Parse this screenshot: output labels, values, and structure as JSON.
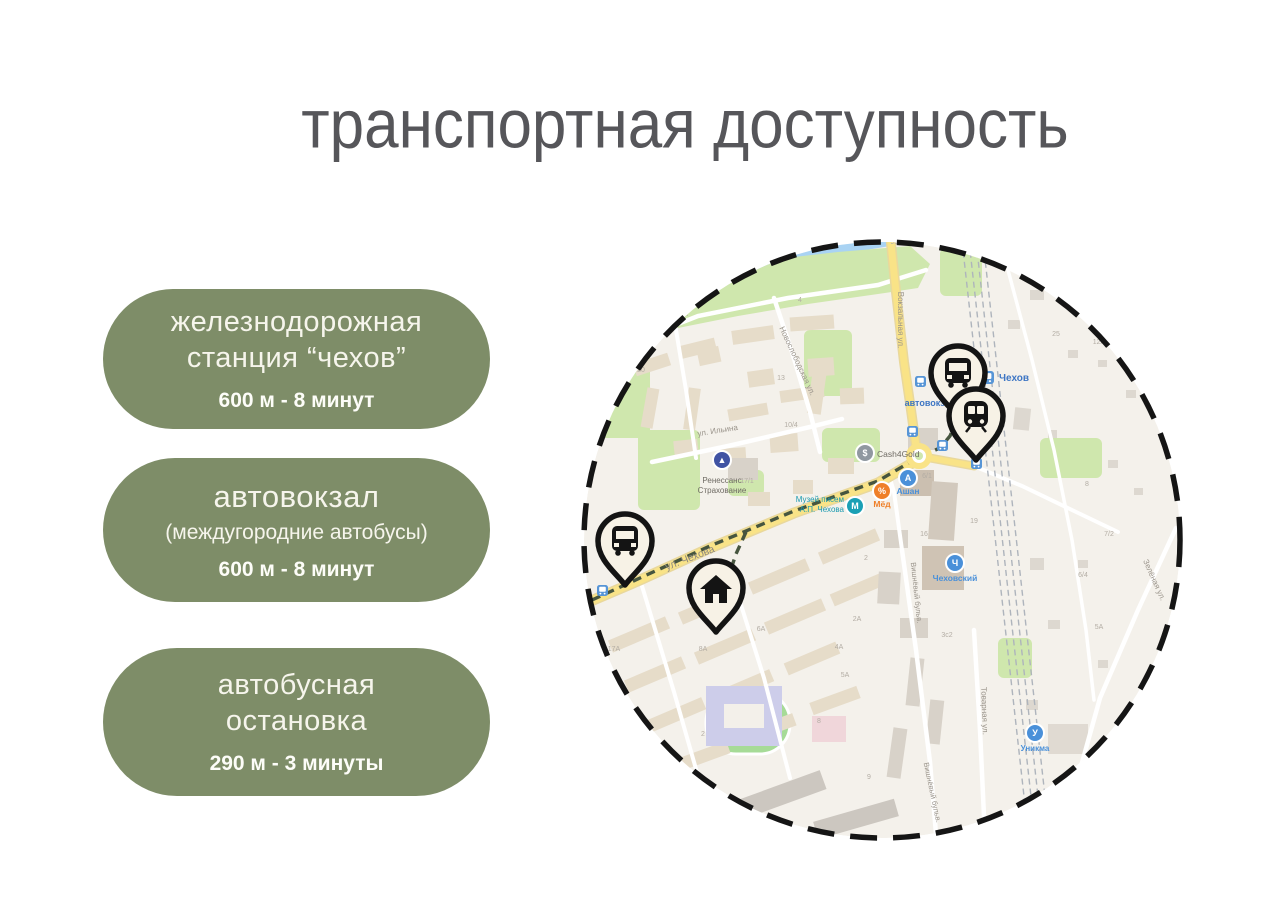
{
  "slide": {
    "title": "транспортная доступность",
    "colors": {
      "card_bg": "#7e8d68",
      "card_text": "#f6f5ec",
      "title_text": "#56565a",
      "accent_route": "#46553f"
    },
    "cards": [
      {
        "title": "железнодорожная станция “чехов”",
        "detail": "600 м  - 8 минут"
      },
      {
        "title": "автовокзал",
        "sub": "(междугородние автобусы)",
        "detail": "600 м  - 8 минут"
      },
      {
        "title": "автобусная остановка",
        "detail": "290 м  - 3 минуты"
      }
    ]
  },
  "map": {
    "palette": {
      "bg": "#f4f1eb",
      "water": "#a9d3f3",
      "green": "#cfe7ad",
      "outline": "#151515",
      "road_yellow": "#f9e387",
      "road_casing": "#e9d89c",
      "road_white": "#ffffff",
      "rail": "#aeb4bc",
      "route": "#46553f",
      "badge_blue": "#5795d6",
      "pin_fill": "#f7f2e6"
    },
    "circle": {
      "cx": 304,
      "cy": 310,
      "r": 301
    },
    "water": [
      "70,62 100,34 150,16 215,6 300,2 312,16 252,26 185,38 132,55 98,70"
    ],
    "park": "55,100 80,62 130,42 190,30 260,22 332,16 352,34 340,58 300,64 230,74 160,86 100,98",
    "greens": [
      [
        17,
        118,
        55,
        90
      ],
      [
        60,
        200,
        62,
        80
      ],
      [
        226,
        100,
        48,
        66
      ],
      [
        244,
        198,
        58,
        34
      ],
      [
        362,
        18,
        42,
        48
      ],
      [
        462,
        208,
        62,
        40
      ],
      [
        420,
        408,
        34,
        40
      ],
      [
        150,
        240,
        36,
        26
      ]
    ],
    "stadium": {
      "x": 128,
      "y": 462,
      "w": 84,
      "h": 62,
      "rx": 30,
      "f": "#a6db97",
      "st": "#ffffff"
    },
    "buildings": [
      [
        56,
        128,
        36,
        13,
        "#e6dcc9",
        -18
      ],
      [
        100,
        112,
        38,
        13,
        "#e6dcc9",
        -14
      ],
      [
        154,
        98,
        42,
        14,
        "#e6dcc9",
        -8
      ],
      [
        212,
        86,
        44,
        14,
        "#e6dcc9",
        -4
      ],
      [
        66,
        158,
        12,
        40,
        "#e6dcc9",
        10
      ],
      [
        108,
        158,
        12,
        42,
        "#e6dcc9",
        8
      ],
      [
        150,
        176,
        40,
        12,
        "#e6dcc9",
        -10
      ],
      [
        202,
        158,
        44,
        12,
        "#e6dcc9",
        -8
      ],
      [
        120,
        118,
        22,
        16,
        "#e6dcc9",
        -12
      ],
      [
        170,
        140,
        26,
        16,
        "#e6dcc9",
        -8
      ],
      [
        230,
        128,
        26,
        18,
        "#e6dcc9",
        -4
      ],
      [
        262,
        158,
        24,
        16,
        "#e6dcc9",
        -2
      ],
      [
        96,
        210,
        24,
        16,
        "#e6dcc9",
        -6
      ],
      [
        142,
        218,
        26,
        16,
        "#e6dcc9",
        -4
      ],
      [
        192,
        204,
        28,
        18,
        "#e6dcc9",
        -4
      ],
      [
        250,
        228,
        26,
        16,
        "#e6dcc9",
        0
      ],
      [
        215,
        250,
        20,
        14,
        "#e6dcc9",
        0
      ],
      [
        170,
        262,
        22,
        14,
        "#e6dcc9",
        0
      ],
      [
        150,
        228,
        30,
        22,
        "#d8d2c9",
        0
      ],
      [
        232,
        138,
        14,
        46,
        "#e6dcc9",
        8
      ],
      [
        30,
        398,
        62,
        13,
        "#e6dcc9",
        -23
      ],
      [
        100,
        370,
        62,
        13,
        "#e6dcc9",
        -23
      ],
      [
        170,
        340,
        62,
        13,
        "#e6dcc9",
        -23
      ],
      [
        240,
        310,
        62,
        13,
        "#e6dcc9",
        -23
      ],
      [
        46,
        438,
        62,
        13,
        "#e6dcc9",
        -23
      ],
      [
        116,
        410,
        62,
        13,
        "#e6dcc9",
        -23
      ],
      [
        186,
        380,
        62,
        13,
        "#e6dcc9",
        -23
      ],
      [
        252,
        353,
        56,
        13,
        "#e6dcc9",
        -23
      ],
      [
        70,
        478,
        58,
        13,
        "#e6dcc9",
        -23
      ],
      [
        138,
        450,
        58,
        13,
        "#e6dcc9",
        -23
      ],
      [
        206,
        422,
        56,
        13,
        "#e6dcc9",
        -23
      ],
      [
        96,
        520,
        56,
        13,
        "#e6dcc9",
        -20
      ],
      [
        164,
        492,
        54,
        13,
        "#e6dcc9",
        -20
      ],
      [
        232,
        464,
        50,
        13,
        "#e6dcc9",
        -20
      ],
      [
        152,
        556,
        96,
        20,
        "#ccc7c0",
        -20
      ],
      [
        236,
        580,
        84,
        18,
        "#ccc7c0",
        -16
      ],
      [
        128,
        456,
        76,
        60,
        "#cdcdea",
        0
      ],
      [
        146,
        474,
        40,
        24,
        "#f3f0ea",
        0
      ],
      [
        234,
        486,
        34,
        26,
        "#f0d6da",
        0
      ],
      [
        330,
        198,
        30,
        22,
        "#d8d2c9",
        0
      ],
      [
        322,
        240,
        34,
        26,
        "#cbbfb0",
        0
      ],
      [
        352,
        252,
        26,
        58,
        "#d2c9bd",
        4
      ],
      [
        344,
        316,
        42,
        44,
        "#cfc3b4",
        0
      ],
      [
        306,
        300,
        24,
        18,
        "#d8d2c9",
        0
      ],
      [
        300,
        342,
        22,
        32,
        "#d8d2c9",
        3
      ],
      [
        322,
        388,
        28,
        20,
        "#d8d2c9",
        0
      ],
      [
        330,
        428,
        14,
        48,
        "#d8d2c9",
        6
      ],
      [
        350,
        470,
        14,
        44,
        "#d8d2c9",
        6
      ],
      [
        312,
        498,
        14,
        50,
        "#d8d2c9",
        8
      ],
      [
        490,
        120,
        10,
        8,
        "#ddd8d0",
        0
      ],
      [
        520,
        130,
        9,
        7,
        "#ddd8d0",
        0
      ],
      [
        548,
        160,
        10,
        8,
        "#ddd8d0",
        0
      ],
      [
        470,
        200,
        9,
        8,
        "#ddd8d0",
        0
      ],
      [
        530,
        230,
        10,
        8,
        "#ddd8d0",
        0
      ],
      [
        556,
        258,
        9,
        7,
        "#ddd8d0",
        0
      ],
      [
        500,
        330,
        10,
        8,
        "#ddd8d0",
        0
      ],
      [
        470,
        390,
        12,
        9,
        "#ddd8d0",
        0
      ],
      [
        520,
        430,
        10,
        8,
        "#ddd8d0",
        0
      ],
      [
        448,
        470,
        12,
        10,
        "#ddd8d0",
        0
      ],
      [
        470,
        494,
        40,
        30,
        "#e0dad2",
        0
      ],
      [
        436,
        178,
        16,
        22,
        "#ddd8d0",
        6
      ],
      [
        452,
        328,
        14,
        12,
        "#ddd8d0",
        0
      ],
      [
        452,
        60,
        14,
        10,
        "#ddd8d0",
        0
      ],
      [
        430,
        90,
        12,
        9,
        "#ddd8d0",
        0
      ]
    ],
    "paths": [
      {
        "pts": "44,116 120,86 210,68 300,55 348,40",
        "c": "#ffffff",
        "w": 4.5,
        "name": "street"
      },
      {
        "pts": "196,68 214,122 232,182 242,222",
        "c": "#ffffff",
        "w": 4.5,
        "name": "street"
      },
      {
        "pts": "74,232 150,216 232,197 264,189",
        "c": "#ffffff",
        "w": 4.5,
        "name": "street"
      },
      {
        "pts": "96,88 108,160 118,228",
        "c": "#ffffff",
        "w": 4,
        "name": "street"
      },
      {
        "pts": "324,320 338,420 352,532 358,604",
        "c": "#ffffff",
        "w": 4.5,
        "name": "street"
      },
      {
        "pts": "324,320 316,262 310,242",
        "c": "#ffffff",
        "w": 4,
        "name": "street"
      },
      {
        "pts": "396,400 402,500 407,608",
        "c": "#ffffff",
        "w": 4.5,
        "name": "street"
      },
      {
        "pts": "598,298 560,380 522,468 502,540 494,610",
        "c": "#ffffff",
        "w": 4.5,
        "name": "street"
      },
      {
        "pts": "396,236 444,256 494,280 540,302",
        "c": "#ffffff",
        "w": 4,
        "name": "street"
      },
      {
        "pts": "64,356 96,462 124,560",
        "c": "#ffffff",
        "w": 4,
        "name": "street"
      },
      {
        "pts": "152,340 186,448 212,548",
        "c": "#ffffff",
        "w": 4,
        "name": "street"
      },
      {
        "pts": "430,40 454,130 476,220 494,310 508,400 516,470",
        "c": "#ffffff",
        "w": 3.5,
        "name": "street"
      },
      {
        "pts": "312,4 318,62 326,132 333,180 338,216",
        "c": "#f9e387",
        "w": 7,
        "cas": "#e9d89c",
        "name": "main-road"
      },
      {
        "pts": "6,374 62,350 132,318 216,283 300,253 336,232 344,226",
        "c": "#f9e387",
        "w": 8,
        "cas": "#e9d89c",
        "name": "main-road"
      },
      {
        "pts": "352,228 396,236",
        "c": "#f9e387",
        "w": 6,
        "cas": "#e9d89c",
        "name": "main-road"
      },
      {
        "pts": "383,2 452,620",
        "c": "#aeb4bc",
        "w": 1.4,
        "dash": "6 4",
        "name": "railway"
      },
      {
        "pts": "390,2 459,620",
        "c": "#aeb4bc",
        "w": 1.4,
        "dash": "6 4",
        "name": "railway"
      },
      {
        "pts": "397,2 466,620",
        "c": "#aeb4bc",
        "w": 1.4,
        "dash": "6 4",
        "name": "railway"
      },
      {
        "pts": "404,2 473,620",
        "c": "#aeb4bc",
        "w": 1.4,
        "dash": "6 4",
        "name": "railway"
      },
      {
        "pts": "14,370 62,348 132,316 216,281 300,251 334,231 348,224 362,218 372,206 378,192",
        "c": "#46553f",
        "w": 3.4,
        "dash": "9 6",
        "name": "route-line"
      },
      {
        "pts": "168,302 158,324 150,348 144,372 140,384",
        "c": "#46553f",
        "w": 3.4,
        "dash": "9 6",
        "name": "route-line"
      }
    ],
    "roundabout": {
      "x": 341,
      "y": 226
    },
    "badges": [
      [
        337,
        146
      ],
      [
        329,
        196
      ],
      [
        359,
        210
      ],
      [
        35,
        333
      ],
      [
        19,
        355
      ],
      [
        393,
        228
      ],
      [
        403,
        141,
        13
      ]
    ],
    "pois": [
      [
        144,
        230,
        "#4053a3",
        "▲"
      ],
      [
        287,
        223,
        "#9098a0",
        "$"
      ],
      [
        277,
        276,
        "#1aa0b5",
        "М"
      ],
      [
        304,
        261,
        "#ef7f28",
        "%"
      ],
      [
        330,
        248,
        "#4a90d9",
        "А"
      ],
      [
        377,
        333,
        "#4a90d9",
        "Ч"
      ],
      [
        457,
        503,
        "#4a90d9",
        "У"
      ]
    ],
    "labels": [
      [
        318,
        14,
        "9с1"
      ],
      [
        222,
        72,
        "4"
      ],
      [
        63,
        142,
        "20"
      ],
      [
        203,
        150,
        "13"
      ],
      [
        213,
        197,
        "10/4"
      ],
      [
        25,
        172,
        "9к2"
      ],
      [
        169,
        253,
        "17/1"
      ],
      [
        478,
        106,
        "25"
      ],
      [
        521,
        114,
        "12А"
      ],
      [
        36,
        421,
        "17А"
      ],
      [
        125,
        421,
        "8А"
      ],
      [
        183,
        401,
        "6А"
      ],
      [
        261,
        419,
        "4А"
      ],
      [
        279,
        391,
        "2А"
      ],
      [
        267,
        447,
        "5А"
      ],
      [
        369,
        407,
        "3с2"
      ],
      [
        349,
        248,
        "6/1"
      ],
      [
        396,
        293,
        "19"
      ],
      [
        346,
        306,
        "16"
      ],
      [
        288,
        330,
        "2"
      ],
      [
        505,
        347,
        "6/4"
      ],
      [
        531,
        306,
        "7/2"
      ],
      [
        521,
        399,
        "5А"
      ],
      [
        509,
        256,
        "8"
      ],
      [
        241,
        493,
        "8"
      ],
      [
        291,
        549,
        "9"
      ],
      [
        125,
        506,
        "2"
      ],
      [
        320,
        90,
        "Вокзальная ул.",
        "#9a948b",
        8,
        90
      ],
      [
        82,
        94,
        "Набережная ул.",
        "#9a948b",
        8,
        -17
      ],
      [
        217,
        132,
        "Новослободская ул.",
        "#9a948b",
        8,
        65
      ],
      [
        140,
        203,
        "ул. Ильина",
        "#9a948b",
        8,
        -9
      ],
      [
        113,
        331,
        "ул. Чехова",
        "#8d8880",
        10.5,
        -21
      ],
      [
        336,
        363,
        "Вишнёвый бульв.",
        "#9a948b",
        7.5,
        84
      ],
      [
        352,
        563,
        "Вишнёвый бульв.",
        "#9a948b",
        7.5,
        78
      ],
      [
        404,
        481,
        "Товарная ул.",
        "#9a948b",
        8,
        88
      ],
      [
        574,
        351,
        "Зелёная ул.",
        "#9a948b",
        8,
        66
      ],
      [
        144,
        253,
        "Ренессанс",
        "#6f6b64",
        8
      ],
      [
        144,
        263,
        "Страхование",
        "#6f6b64",
        8
      ],
      [
        299,
        227,
        "Cash4Gold",
        "#6f6b64",
        8.5,
        0,
        0,
        "start"
      ],
      [
        266,
        272,
        "Музей писем",
        "#1a9ab0",
        8,
        0,
        0,
        "end"
      ],
      [
        266,
        282,
        "А.П. Чехова",
        "#1a9ab0",
        8,
        0,
        0,
        "end"
      ],
      [
        304,
        277,
        "Мёд",
        "#ef7f28",
        8.5,
        0,
        1
      ],
      [
        330,
        264,
        "Ашан",
        "#4a90d9",
        8.5,
        0,
        1
      ],
      [
        377,
        351,
        "Чеховский",
        "#4a90d9",
        8.5,
        0,
        1
      ],
      [
        457,
        521,
        "Уникма",
        "#4a90d9",
        8,
        0,
        1
      ],
      [
        421,
        151,
        "Чехов",
        "#3e76c4",
        10,
        0,
        1,
        "start"
      ],
      [
        352,
        176,
        "автовокзал",
        "#3e76c4",
        9,
        0,
        1
      ]
    ],
    "pins": [
      {
        "t": "bus",
        "x": 380,
        "y": 145
      },
      {
        "t": "train",
        "x": 398,
        "y": 188
      },
      {
        "t": "bus",
        "x": 47,
        "y": 313
      },
      {
        "t": "house",
        "x": 138,
        "y": 360
      }
    ]
  }
}
